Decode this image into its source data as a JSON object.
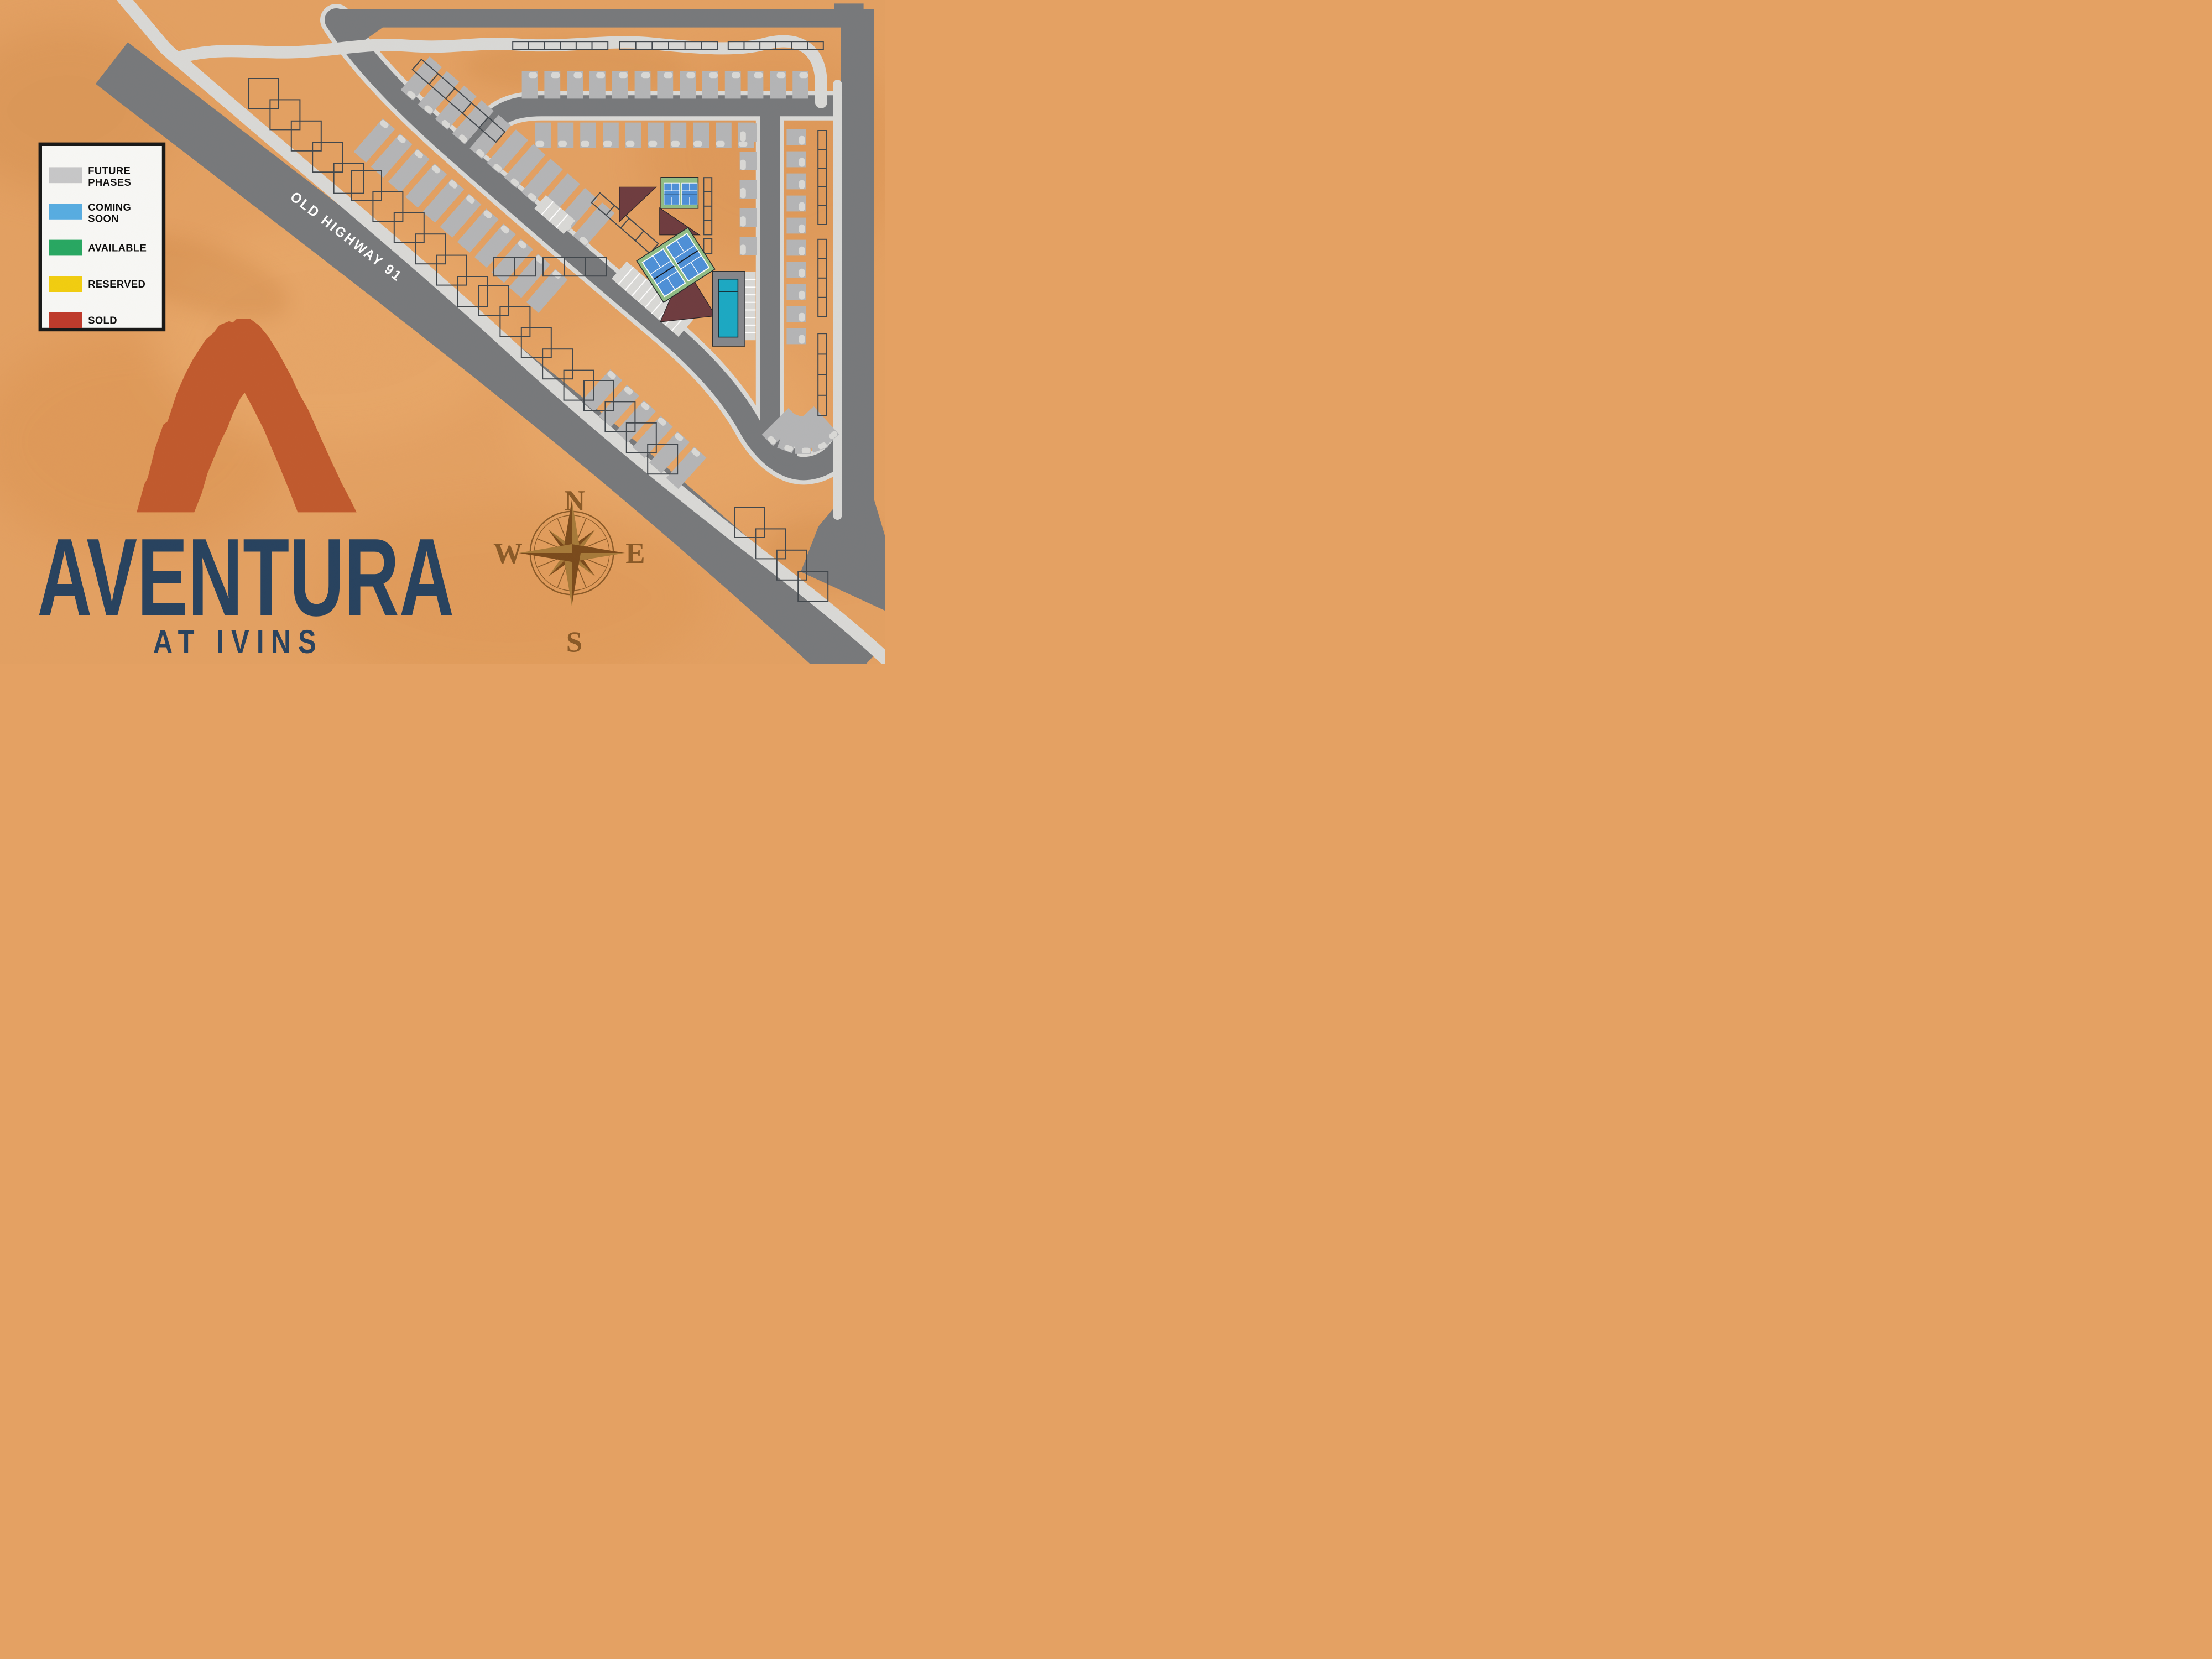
{
  "map": {
    "name": "Aventura at Ivins community site plan",
    "palette": {
      "background": "#e4a163",
      "road_dark": "#77797c",
      "road_light": "#d9d9d7",
      "future_lot_gray": "#b4b5b7",
      "lot_outline": "#41474d",
      "building_maroon": "#6e3c40",
      "court_pad_green": "#90bd85",
      "court_blue": "#4e90d8",
      "pool_deck_gray": "#85868b",
      "pool_water_teal": "#1ba9c4",
      "compass_brown": "#8a5a28",
      "logo_rust": "#c15a2e",
      "logo_navy": "#27425f"
    }
  },
  "legend": {
    "items": [
      {
        "name": "future-phases",
        "lines": [
          "FUTURE",
          "PHASES"
        ],
        "color": "#c7c7c9"
      },
      {
        "name": "coming-soon",
        "lines": [
          "COMING",
          "SOON"
        ],
        "color": "#57ade2"
      },
      {
        "name": "available",
        "lines": [
          "AVAILABLE"
        ],
        "color": "#27a862"
      },
      {
        "name": "reserved",
        "lines": [
          "RESERVED"
        ],
        "color": "#f2ce10"
      },
      {
        "name": "sold",
        "lines": [
          "SOLD"
        ],
        "color": "#bf3a2c"
      }
    ]
  },
  "highway": {
    "label": "OLD HIGHWAY 91"
  },
  "compass": {
    "north": "N",
    "east": "E",
    "south": "S",
    "west": "W"
  },
  "logo": {
    "name": "AVENTURA",
    "tagline": "AT IVINS"
  },
  "icons": {
    "compass": "compass-rose-icon",
    "arch": "arch-monument-icon"
  }
}
